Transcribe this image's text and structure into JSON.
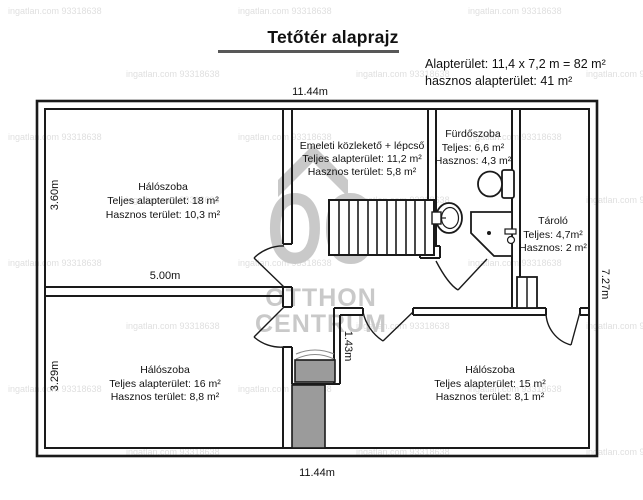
{
  "title": "Tetőtér alaprajz",
  "info": {
    "line1": "Alapterület: 11,4 x 7,2 m = 82 m²",
    "line2": "hasznos alapterület: 41 m²"
  },
  "watermark": {
    "letters": "OC",
    "line1": "OTTHON",
    "line2": "CENTRUM",
    "tile": "ingatlan.com 93318638"
  },
  "dimensions": {
    "top": "11.44m",
    "bottom": "11.44m",
    "left_top": "3.60m",
    "left_bottom": "3.29m",
    "right": "7.27m",
    "inner_width": "5.00m",
    "inner_height": "1.43m"
  },
  "rooms": {
    "bedroom_top_left": {
      "name": "Hálószoba",
      "total": "Teljes alapterület: 18 m²",
      "useful": "Hasznos terület: 10,3 m²"
    },
    "hall": {
      "name": "Emeleti közlekető + lépcső",
      "total": "Teljes alapterület: 11,2 m²",
      "useful": "Hasznos terület: 5,8 m²"
    },
    "bathroom": {
      "name": "Fürdőszoba",
      "total": "Teljes: 6,6 m²",
      "useful": "Hasznos: 4,3 m²"
    },
    "storage": {
      "name": "Tároló",
      "total": "Teljes: 4,7m²",
      "useful": "Hasznos: 2 m²"
    },
    "bedroom_bottom_left": {
      "name": "Hálószoba",
      "total": "Teljes alapterület: 16 m²",
      "useful": "Hasznos terület: 8,8 m²"
    },
    "bedroom_bottom_right": {
      "name": "Hálószoba",
      "total": "Teljes alapterület: 15 m²",
      "useful": "Hasznos terület: 8,1 m²"
    }
  }
}
